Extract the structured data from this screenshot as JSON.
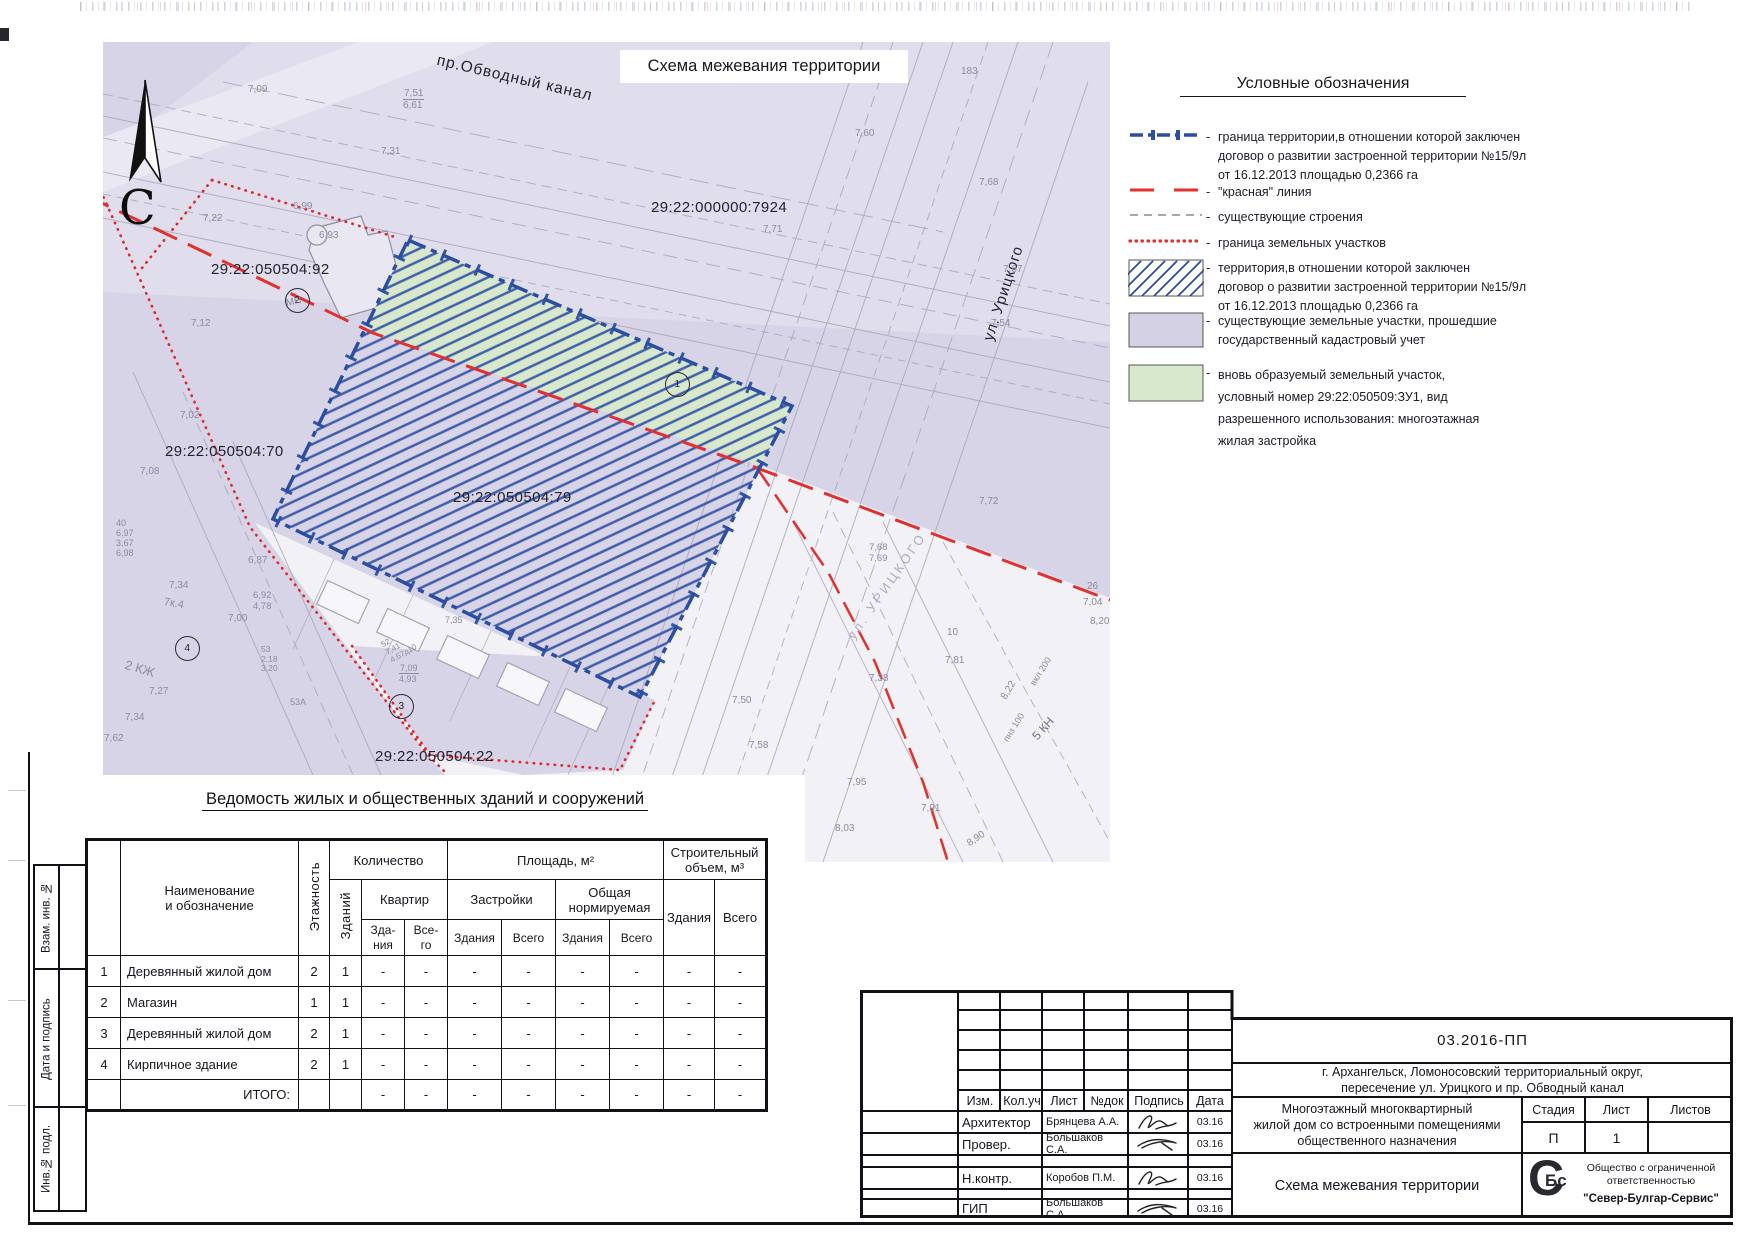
{
  "map": {
    "title": "Схема межевания территории",
    "north": "С",
    "labels": [
      {
        "t": "29:22:000000:7924",
        "x": 548,
        "y": 158,
        "s": 15,
        "c": "d"
      },
      {
        "t": "29:22:050504:92",
        "x": 108,
        "y": 220,
        "s": 15,
        "c": "d"
      },
      {
        "t": "29:22:050504:70",
        "x": 62,
        "y": 402,
        "s": 15,
        "c": "d"
      },
      {
        "t": "29:22:050504:79",
        "x": 350,
        "y": 448,
        "s": 15,
        "c": "d"
      },
      {
        "t": "29:22:050504:22",
        "x": 272,
        "y": 707,
        "s": 15,
        "c": "d"
      },
      {
        "t": "пр.Обводный канал",
        "x": 336,
        "y": 10,
        "s": 15.5,
        "c": "d",
        "r": 13,
        "ls": 1
      },
      {
        "t": "ул. Урицкого",
        "x": 878,
        "y": 296,
        "s": 15,
        "c": "d",
        "r": -72,
        "ls": 1
      },
      {
        "t": "1",
        "x": 562,
        "y": 330,
        "c": "d",
        "o": true
      },
      {
        "t": "2",
        "x": 182,
        "y": 246,
        "c": "d",
        "o": true
      },
      {
        "t": "3",
        "x": 286,
        "y": 652,
        "c": "d",
        "o": true
      },
      {
        "t": "4",
        "x": 72,
        "y": 594,
        "c": "d",
        "o": true
      },
      {
        "t": "7,09",
        "x": 145,
        "y": 42
      },
      {
        "t": "7,51\n6,61",
        "x": 300,
        "y": 46,
        "f": true
      },
      {
        "t": "7,31",
        "x": 278,
        "y": 104
      },
      {
        "t": "Мп",
        "x": 740,
        "y": 8
      },
      {
        "t": "183",
        "x": 858,
        "y": 24
      },
      {
        "t": "7,60",
        "x": 752,
        "y": 86
      },
      {
        "t": "7,68",
        "x": 876,
        "y": 135
      },
      {
        "t": "7,71",
        "x": 660,
        "y": 182
      },
      {
        "t": "7,67",
        "x": 900,
        "y": 222
      },
      {
        "t": "7,54",
        "x": 888,
        "y": 276
      },
      {
        "t": "6,99",
        "x": 190,
        "y": 159
      },
      {
        "t": "6,93",
        "x": 216,
        "y": 188
      },
      {
        "t": "7,22",
        "x": 100,
        "y": 171
      },
      {
        "t": "7,12",
        "x": 88,
        "y": 276
      },
      {
        "t": "7,02",
        "x": 77,
        "y": 368
      },
      {
        "t": "7,08",
        "x": 37,
        "y": 424
      },
      {
        "t": "40\n6,97\n3,67\n6,98",
        "x": 13,
        "y": 476,
        "s": 9
      },
      {
        "t": "7,34",
        "x": 66,
        "y": 538
      },
      {
        "t": "6,87",
        "x": 145,
        "y": 513
      },
      {
        "t": "6,92\n4,78",
        "x": 150,
        "y": 549,
        "s": 9.5
      },
      {
        "t": "7,00",
        "x": 125,
        "y": 571
      },
      {
        "t": "7к.4",
        "x": 62,
        "y": 554,
        "s": 11,
        "r": 10
      },
      {
        "t": "2 КЖ",
        "x": 24,
        "y": 616,
        "s": 13,
        "r": 16
      },
      {
        "t": "7,27",
        "x": 46,
        "y": 644
      },
      {
        "t": "7,34",
        "x": 22,
        "y": 670
      },
      {
        "t": "7,62",
        "x": 1,
        "y": 691
      },
      {
        "t": "53\n2,18\n3,20",
        "x": 158,
        "y": 603,
        "s": 8.5
      },
      {
        "t": "53А",
        "x": 187,
        "y": 655,
        "s": 9
      },
      {
        "t": "7,09\n4,93",
        "x": 296,
        "y": 621,
        "s": 9,
        "f": true
      },
      {
        "t": "52\n7,41\n4,67д10",
        "x": 277,
        "y": 600,
        "s": 8,
        "r": -30
      },
      {
        "t": "7,35",
        "x": 342,
        "y": 573,
        "s": 9
      },
      {
        "t": "7,50",
        "x": 629,
        "y": 653
      },
      {
        "t": "7,58",
        "x": 646,
        "y": 698
      },
      {
        "t": "7,68\n7,69",
        "x": 766,
        "y": 501,
        "s": 9.5
      },
      {
        "t": "7,72",
        "x": 876,
        "y": 454
      },
      {
        "t": "26",
        "x": 984,
        "y": 539
      },
      {
        "t": "7,04",
        "x": 980,
        "y": 555
      },
      {
        "t": "8,20",
        "x": 987,
        "y": 574
      },
      {
        "t": "10",
        "x": 844,
        "y": 585
      },
      {
        "t": "7,81",
        "x": 842,
        "y": 613
      },
      {
        "t": "7,38",
        "x": 766,
        "y": 631
      },
      {
        "t": "8,22",
        "x": 896,
        "y": 654,
        "r": -60
      },
      {
        "t": "вкл 200",
        "x": 925,
        "y": 640,
        "s": 9,
        "r": -58
      },
      {
        "t": "пнз 100",
        "x": 898,
        "y": 696,
        "s": 9,
        "r": -58
      },
      {
        "t": "5 КН",
        "x": 927,
        "y": 692,
        "s": 12,
        "r": -48,
        "c": "gd"
      },
      {
        "t": "8,90",
        "x": 862,
        "y": 798,
        "r": -35
      },
      {
        "t": "7,91",
        "x": 818,
        "y": 761
      },
      {
        "t": "8,03",
        "x": 732,
        "y": 781
      },
      {
        "t": "7,95",
        "x": 744,
        "y": 735
      },
      {
        "t": "ул. УРИЦКОГО",
        "x": 742,
        "y": 592,
        "s": 13,
        "r": -55,
        "c": "f",
        "ls": 3
      },
      {
        "t": "МН",
        "x": 182,
        "y": 256,
        "s": 10,
        "r": -12
      }
    ]
  },
  "legend": {
    "title": "Условные обозначения",
    "dash": "-",
    "items": [
      {
        "symbol": "boundary-blue",
        "lines": [
          "граница территории,в отношении которой заключен",
          "договор о развитии застроенной территории №15/9л",
          "от 16.12.2013 площадью 0,2366 га"
        ]
      },
      {
        "symbol": "red-dash",
        "lines": [
          "\"красная\" линия"
        ]
      },
      {
        "symbol": "gray-dash",
        "lines": [
          "существующие строения"
        ]
      },
      {
        "symbol": "red-dots",
        "lines": [
          "граница земельных участков"
        ]
      },
      {
        "symbol": "hatch",
        "lines": [
          "территория,в отношении которой заключен",
          "договор о развитии застроенной территории №15/9л",
          "от 16.12.2013 площадью 0,2366 га"
        ]
      },
      {
        "symbol": "lavender",
        "lines": [
          "существующие земельные участки, прошедшие",
          "государственный кадастровый учет"
        ]
      },
      {
        "symbol": "green",
        "lines": [
          "вновь образуемый земельный участок,",
          "условный номер 29:22:050509:ЗУ1, вид",
          "разрешенного использования: многоэтажная",
          "жилая застройка"
        ]
      }
    ]
  },
  "schedule": {
    "title": "Ведомость жилых и общественных зданий и сооружений",
    "h": {
      "name": "Наименование\nи обозначение",
      "floors": "Этажность",
      "qty": "Количество",
      "bld_v": "Зданий",
      "apt": "Квартир",
      "apt_b": "Зда-\nния",
      "apt_t": "Все-\nго",
      "area": "Площадь, м²",
      "built": "Застройки",
      "norm": "Общая\nнормируемая",
      "bld": "Здания",
      "tot": "Всего",
      "vol": "Строительный\nобъем, м³"
    },
    "rows": [
      [
        "1",
        "Деревянный жилой дом",
        "2",
        "1",
        "-",
        "-",
        "-",
        "-",
        "-",
        "-",
        "-",
        "-"
      ],
      [
        "2",
        "Магазин",
        "1",
        "1",
        "-",
        "-",
        "-",
        "-",
        "-",
        "-",
        "-",
        "-"
      ],
      [
        "3",
        "Деревянный жилой дом",
        "2",
        "1",
        "-",
        "-",
        "-",
        "-",
        "-",
        "-",
        "-",
        "-"
      ],
      [
        "4",
        "Кирпичное здание",
        "2",
        "1",
        "-",
        "-",
        "-",
        "-",
        "-",
        "-",
        "-",
        "-"
      ]
    ],
    "total_label": "ИТОГО:",
    "total_vals": [
      "-",
      "-",
      "-",
      "-",
      "-",
      "-",
      "-",
      "-"
    ]
  },
  "sidebar": {
    "boxes": [
      "Взам. инв. №",
      "Дата и подпись",
      "Инв.№ подл."
    ]
  },
  "titleblock": {
    "doc_number": "03.2016-ПП",
    "location_line1": "г. Архангельск, Ломоносовский территориальный округ,",
    "location_line2": "пересечение ул. Урицкого и пр. Обводный канал",
    "project_line1": "Многоэтажный многоквартирный",
    "project_line2": "жилой дом со встроенными помещениями",
    "project_line3": "общественного назначения",
    "sheet_title": "Схема межевания территории",
    "stage_label": "Стадия",
    "sheet_label": "Лист",
    "sheets_label": "Листов",
    "stage_value": "П",
    "sheet_value": "1",
    "sheets_value": "",
    "header_cols": [
      "Изм.",
      "Кол.уч",
      "Лист",
      "№док",
      "Подпись",
      "Дата"
    ],
    "sig_rows": [
      {
        "role": "Архитектор",
        "name": "Брянцева А.А.",
        "date": "03.16",
        "sig": 1
      },
      {
        "role": "Провер.",
        "name": "Большаков С.А.",
        "date": "03.16",
        "sig": 2
      },
      {
        "role": "",
        "name": "",
        "date": "",
        "sig": 0
      },
      {
        "role": "Н.контр.",
        "name": "Коробов П.М.",
        "date": "03.16",
        "sig": 1
      },
      {
        "role": "",
        "name": "",
        "date": "",
        "sig": 0
      },
      {
        "role": "ГИП",
        "name": "Большаков С.А.",
        "date": "03.16",
        "sig": 2
      }
    ],
    "logo_big": "С",
    "logo_small": "Бс",
    "company_line1": "Общество с ограниченной",
    "company_line2": "ответственностью",
    "company_line3": "\"Север-Булгар-Сервис\""
  },
  "colors": {
    "boundary_blue": "#2b4da2",
    "red_line": "#e03030",
    "lavender": "#d7d4e7",
    "green": "#d7e8cd"
  }
}
